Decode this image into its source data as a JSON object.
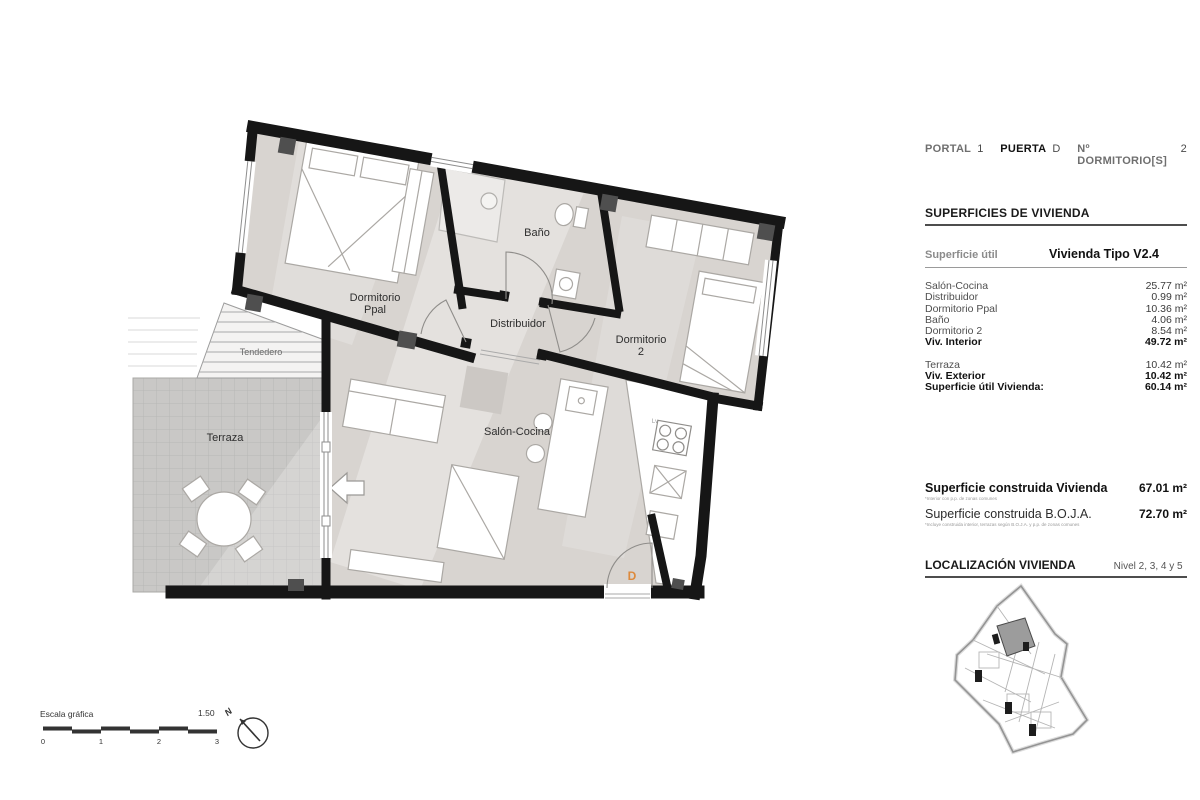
{
  "header": {
    "portal_label": "PORTAL",
    "portal_value": "1",
    "puerta_label": "PUERTA",
    "puerta_value": "D",
    "dorm_label": "Nº DORMITORIO[S]",
    "dorm_value": "2"
  },
  "superficies": {
    "title": "SUPERFICIES DE VIVIENDA",
    "util_label": "Superficie útil",
    "tipo_value": "Vivienda Tipo V2.4",
    "rows": [
      {
        "label": "Salón-Cocina",
        "value": "25.77 m²"
      },
      {
        "label": "Distribuidor",
        "value": "0.99 m²"
      },
      {
        "label": "Dormitorio Ppal",
        "value": "10.36 m²"
      },
      {
        "label": "Baño",
        "value": "4.06 m²"
      },
      {
        "label": "Dormitorio 2",
        "value": "8.54 m²"
      },
      {
        "label": "Viv. Interior",
        "value": "49.72 m²"
      },
      {
        "label": "Terraza",
        "value": "10.42 m²"
      },
      {
        "label": "Viv. Exterior",
        "value": "10.42 m²"
      },
      {
        "label": "Superficie útil Vivienda:",
        "value": "60.14 m²"
      }
    ]
  },
  "construida": {
    "vivienda_label": "Superficie construida Vivienda",
    "vivienda_note": "*Interior con p.p. de zonas comunes",
    "vivienda_value": "67.01 m²",
    "boja_label": "Superficie construida B.O.J.A.",
    "boja_note": "*Incluye construida interior, terrazas según B.O.J.A. y p.p. de zonas comunes",
    "boja_value": "72.70 m²"
  },
  "localizacion": {
    "title": "LOCALIZACIÓN VIVIENDA",
    "nivel": "Nivel 2, 3, 4 y 5"
  },
  "plan": {
    "rooms": {
      "dormitorio_ppal_1": "Dormitorio",
      "dormitorio_ppal_2": "Ppal",
      "bano": "Baño",
      "distribuidor": "Distribuidor",
      "dormitorio2_1": "Dormitorio",
      "dormitorio2_2": "2",
      "salon": "Salón-Cocina",
      "terraza": "Terraza",
      "tendedero": "Tendedero"
    },
    "door_letter": "D",
    "door_letter_color": "#dd8a3d",
    "dishwasher_label": "Lv"
  },
  "scale": {
    "label": "Escala gráfica",
    "ratio": "1.50",
    "ticks": [
      "0",
      "1",
      "2",
      "3"
    ]
  },
  "north_label": "N"
}
